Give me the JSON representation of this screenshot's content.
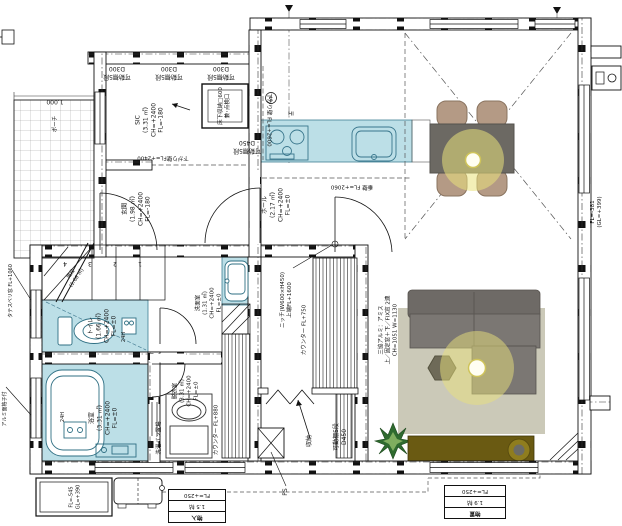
{
  "palette": {
    "water_area": "#bcdfe7",
    "water_line": "#3f7f93",
    "wall_ink": "#111111",
    "rug": "#cbc9b8",
    "sofa": "#76726e",
    "dining_table": "#6c6963",
    "chair": "#b49a85",
    "tv_board": "#6a5a12",
    "light_glow": "#e9e17c",
    "plant": "#2f6b2f"
  },
  "rooms": {
    "sic": "SIC\n(3.31 ㎡)\nCH=+2400\nFL=-180",
    "genkan": "玄関\n(1.98 ㎡)\nCH=+2400\nFL=-180",
    "hall": "ホール\n(2.17 ㎡)\nCH=+2400\nFL=±0",
    "toilet": "トイレ\n(1.66 ㎡)\nCH=+2400\nFL=±0",
    "senmen": "洗面室\n(1.31 ㎡)\nCH=+2400\nFL=±0",
    "bath": "浴室\n(3.31 ㎡)\nCH=+2400\nFL=±0",
    "datsui": "脱衣室\n(3.31 ㎡)\nCH=+2400\nFL=±0",
    "stairs": "階段\n(1.66 ㎡)",
    "shuno": "収納"
  },
  "annotations": {
    "shelf_d300": "可動棚5段\nD300",
    "shelf_d450": "可動棚5段\nD450",
    "floor_hatch": "床下収納□600\n兼･点検口",
    "sagari_2600": "下がり壁 FL=+2600",
    "sagari_2400": "下がり壁FL=+2400",
    "tarekabe": "垂壁 FL=+2060",
    "ih": "IH",
    "s_mark": "S",
    "niche": "ニッチ(W600×H450)\n上端FL+1600",
    "counter_750": "カウンター FL+750",
    "counter_880": "カウンター FL+880",
    "window_spec": "三協アルミ：アミス\n上／固定窓＋下／FIX窓 2連\nCH=1051 W=1130",
    "fl_right": "FL=-381\n(GL=+399)",
    "fl_porch": "FL=-545\nGL=+390",
    "h24": "24H",
    "laundry": "洗濯パン置場",
    "ps": "PS",
    "porch": "ポーチ",
    "dim_1000": "1,000",
    "tatesuberi": "タテスベリ窓 FL+1060",
    "mengoshi": "アルミ面格子付"
  },
  "stair_numbers": [
    "1",
    "2",
    "3",
    "4"
  ],
  "area_tables": {
    "left": {
      "rows": [
        "物入",
        "1.5 帖",
        "FL=+250"
      ]
    },
    "right": {
      "rows": [
        "物置",
        "1.9 帖",
        "FL=+250"
      ]
    }
  }
}
